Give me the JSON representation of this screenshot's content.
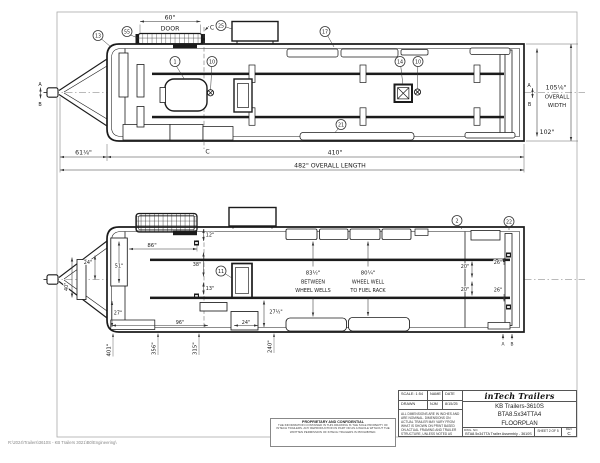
{
  "sheet": {
    "footer_path": "R:\\2024\\Trailers\\3610S - KB Trailers 3021\\B0\\Engineering\\"
  },
  "top_view": {
    "door_dim": "60\"",
    "door_label": "DOOR",
    "section_label_top": "C",
    "section_label_bottom": "C",
    "datum_front_a": "A",
    "datum_front_b": "B",
    "datum_right_a": "A",
    "datum_right_b": "B",
    "tongue_length": "61⅛\"",
    "box_length": "410\"",
    "overall_length": "482\" OVERALL LENGTH",
    "overall_width": "105⅛\"",
    "overall_width_word1": "OVERALL",
    "overall_width_word2": "WIDTH",
    "interior_width": "102\"",
    "balloons": [
      "13",
      "55",
      "25",
      "17",
      "1",
      "10",
      "14",
      "10",
      "21"
    ]
  },
  "bottom_view": {
    "dim_86": "86\"",
    "dim_51": "51\"",
    "dim_24_tongue": "24\"",
    "dim_40_tongue": "40\"",
    "dim_12": "12\"",
    "dim_38": "38\"",
    "dim_13": "13\"",
    "dim_27": "27\"",
    "dim_96": "96\"",
    "dim_24_floor": "24\"",
    "dim_27_half": "27½\"",
    "wheelwell_dim": "83½\"",
    "wheelwell_line1": "BETWEEN",
    "wheelwell_line2": "WHEEL WELLS",
    "fuelrack_dim": "80¼\"",
    "fuelrack_line1": "WHEEL WELL",
    "fuelrack_line2": "TO FUEL RACK",
    "dim_20_top": "20\"",
    "dim_20_bottom": "20\"",
    "dim_26_top": "26\"",
    "dim_26_bottom": "26\"",
    "station_dims": [
      "401\"",
      "356\"",
      "315\"",
      "240\""
    ],
    "balloons": [
      "11",
      "2",
      "22"
    ],
    "rear_mark_a": "A",
    "rear_mark_b": "B"
  },
  "title_block": {
    "scale": "SCALE: 1:54",
    "name_label": "NAME",
    "date_label": "DATE",
    "drawn_label": "DRAWN",
    "drawn_name": "NJM",
    "drawn_date": "8/15/25",
    "notes": "ALL DIMENSIONS ARE IN INCHES AND ARE NOMINAL. DIMENSIONS ON ACTUAL TRAILER MAY VARY FROM WHAT IS SHOWN ON PRINT BASED ON ACTUAL FRAMING AND TRAILER STRUCTURE, UNLESS NOTED AS CRITICAL",
    "logo": "inTech Trailers",
    "product_line1": "KB Trailers-3610S",
    "product_line2": "BTA8.5x34TTA4",
    "product_line3": "FLOORPLAN",
    "dwg_no_label": "DWG. NO.",
    "dwg_title": "BTA8.5x34TTA Trailer Assembly - 3610S",
    "sheet_label": "SHEET 2 OF 5",
    "rev_label": "REV",
    "rev_value": "C"
  },
  "proprietary": {
    "heading": "PROPRIETARY AND CONFIDENTIAL",
    "body": "THE INFORMATION CONTAINED IN THIS DRAWING IS THE SOLE PROPERTY OF INTECH TRAILERS. ANY REPRODUCTION IN PART OR AS A WHOLE WITHOUT THE WRITTEN PERMISSION OF INTECH TRAILERS IS PROHIBITED."
  }
}
